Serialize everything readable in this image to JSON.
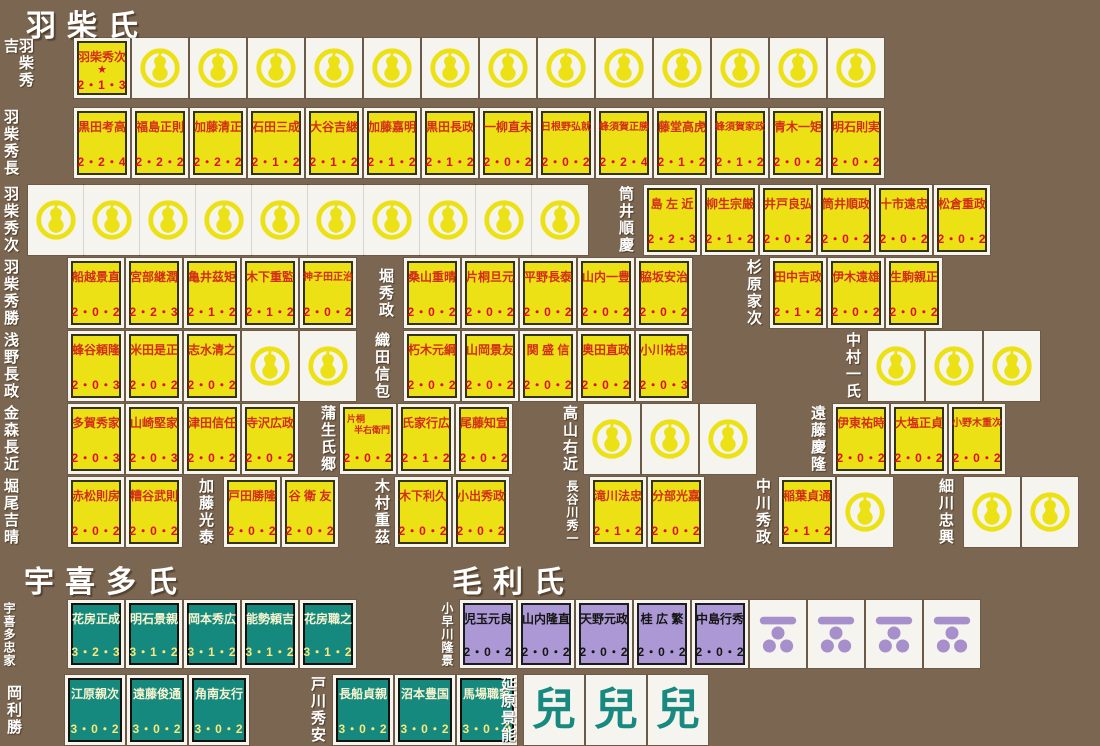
{
  "clans": [
    {
      "title": "羽柴氏"
    },
    {
      "title": "宇喜多氏"
    },
    {
      "title": "毛利氏"
    }
  ],
  "colors": {
    "background": "#7b6751",
    "card_white": "#f6f4ee",
    "unit_yellow": "#ece114",
    "unit_yellow_name": "#d32d18",
    "unit_yellow_stats": "#e20d20",
    "unit_teal": "#15897e",
    "unit_teal_name": "#f8f3cf",
    "unit_teal_stats": "#fbe77d",
    "unit_purple": "#ac98d4",
    "mon_yellow": "#ece114",
    "mon_purple": "#a78fcb",
    "ko_teal": "#17897f",
    "label_white": "#ffffff"
  },
  "glyphs": {
    "ko": "兒",
    "ace_star": "★"
  },
  "groups": [
    {
      "leader": "羽柴秀吉",
      "lx": 3,
      "cx": 74,
      "y": 38,
      "h": 60,
      "cards": [
        {
          "t": "y",
          "n": "羽柴秀次",
          "v": "2・1・3",
          "star": true
        },
        {
          "t": "g",
          "c": 13
        }
      ]
    },
    {
      "leader": "羽柴秀長",
      "lx": 3,
      "cx": 74,
      "y": 108,
      "cards": [
        {
          "t": "y",
          "n": "黒田考高",
          "v": "2・2・4"
        },
        {
          "t": "y",
          "n": "福島正則",
          "v": "2・2・2"
        },
        {
          "t": "y",
          "n": "加藤清正",
          "v": "2・2・2"
        },
        {
          "t": "y",
          "n": "石田三成",
          "v": "2・1・2"
        },
        {
          "t": "y",
          "n": "大谷吉継",
          "v": "2・1・2"
        },
        {
          "t": "y",
          "n": "加藤嘉明",
          "v": "2・1・2"
        },
        {
          "t": "y",
          "n": "黒田長政",
          "v": "2・1・2"
        },
        {
          "t": "y",
          "n": "一柳直未",
          "v": "2・0・2"
        },
        {
          "t": "y",
          "n": "日根野弘就",
          "v": "2・0・2"
        },
        {
          "t": "y",
          "n": "蜂須賀正勝",
          "v": "2・2・4"
        },
        {
          "t": "y",
          "n": "藤堂高虎",
          "v": "2・1・2"
        },
        {
          "t": "y",
          "n": "蜂須賀家政",
          "v": "2・1・2"
        },
        {
          "t": "y",
          "n": "青木一矩",
          "v": "2・0・2"
        },
        {
          "t": "y",
          "n": "明石則実",
          "v": "2・0・2"
        }
      ]
    },
    {
      "leader": "羽柴秀次",
      "lx": 3,
      "cx": 28,
      "y": 185,
      "gap": 0,
      "cards": [
        {
          "t": "g",
          "c": 10
        }
      ]
    },
    {
      "leader": "筒井順慶",
      "lx": 618,
      "cx": 644,
      "y": 185,
      "cards": [
        {
          "t": "y",
          "n": "島 左 近",
          "v": "2・2・3"
        },
        {
          "t": "y",
          "n": "柳生宗厳",
          "v": "2・1・2"
        },
        {
          "t": "y",
          "n": "井戸良弘",
          "v": "2・0・2"
        },
        {
          "t": "y",
          "n": "筒井順政",
          "v": "2・0・2"
        },
        {
          "t": "y",
          "n": "十市遠忠",
          "v": "2・0・2"
        },
        {
          "t": "y",
          "n": "松倉重政",
          "v": "2・0・2"
        }
      ]
    },
    {
      "leader": "羽柴秀勝",
      "lx": 3,
      "cx": 68,
      "y": 258,
      "cards": [
        {
          "t": "y",
          "n": "船越景直",
          "v": "2・0・2"
        },
        {
          "t": "y",
          "n": "宮部継潤",
          "v": "2・2・3"
        },
        {
          "t": "y",
          "n": "亀井茲矩",
          "v": "2・1・2"
        },
        {
          "t": "y",
          "n": "木下重監",
          "v": "2・1・2"
        },
        {
          "t": "y",
          "n": "神子田正治",
          "v": "2・0・2"
        }
      ]
    },
    {
      "leader": "堀秀政",
      "lx": 378,
      "cx": 404,
      "y": 258,
      "cards": [
        {
          "t": "y",
          "n": "桑山重晴",
          "v": "2・0・2"
        },
        {
          "t": "y",
          "n": "片桐旦元",
          "v": "2・0・2"
        },
        {
          "t": "y",
          "n": "平野長泰",
          "v": "2・0・2"
        },
        {
          "t": "y",
          "n": "山内一豊",
          "v": "2・0・2"
        },
        {
          "t": "y",
          "n": "脇坂安治",
          "v": "2・0・2"
        }
      ]
    },
    {
      "leader": "杉原家次",
      "lx": 746,
      "cx": 770,
      "y": 258,
      "cards": [
        {
          "t": "y",
          "n": "田中吉政",
          "v": "2・1・2"
        },
        {
          "t": "y",
          "n": "伊木遠雄",
          "v": "2・0・2"
        },
        {
          "t": "y",
          "n": "生駒親正",
          "v": "2・0・2"
        }
      ]
    },
    {
      "leader": "浅野長政",
      "lx": 3,
      "cx": 68,
      "y": 331,
      "cards": [
        {
          "t": "y",
          "n": "蜂谷頼隆",
          "v": "2・0・3"
        },
        {
          "t": "y",
          "n": "米田是正",
          "v": "2・0・2"
        },
        {
          "t": "y",
          "n": "志水清之",
          "v": "2・0・2"
        },
        {
          "t": "g",
          "c": 2
        }
      ]
    },
    {
      "leader": "織田信包",
      "lx": 374,
      "cx": 404,
      "y": 331,
      "cards": [
        {
          "t": "y",
          "n": "朽木元綱",
          "v": "2・0・2"
        },
        {
          "t": "y",
          "n": "山岡景友",
          "v": "2・0・2"
        },
        {
          "t": "y",
          "n": "関 盛 信",
          "v": "2・0・2"
        },
        {
          "t": "y",
          "n": "奥田直政",
          "v": "2・0・2"
        },
        {
          "t": "y",
          "n": "小川祐忠",
          "v": "2・0・3"
        }
      ]
    },
    {
      "leader": "中村一氏",
      "lx": 845,
      "cx": 868,
      "y": 331,
      "cards": [
        {
          "t": "g",
          "c": 3
        }
      ]
    },
    {
      "leader": "金森長近",
      "lx": 3,
      "cx": 68,
      "y": 404,
      "cards": [
        {
          "t": "y",
          "n": "多賀秀家",
          "v": "2・0・3"
        },
        {
          "t": "y",
          "n": "山崎堅家",
          "v": "2・0・3"
        },
        {
          "t": "y",
          "n": "津田信任",
          "v": "2・0・2"
        },
        {
          "t": "y",
          "n": "寺沢広政",
          "v": "2・0・2"
        }
      ]
    },
    {
      "leader": "蒲生氏郷",
      "lx": 320,
      "cx": 340,
      "y": 404,
      "cards": [
        {
          "t": "y",
          "n": "片桐半右衛門",
          "n2": [
            "片桐",
            "半右衛門"
          ],
          "v": "2・0・2"
        },
        {
          "t": "y",
          "n": "氏家行広",
          "v": "2・1・2"
        },
        {
          "t": "y",
          "n": "尾藤知宣",
          "v": "2・0・2"
        }
      ]
    },
    {
      "leader": "高山右近",
      "lx": 562,
      "cx": 584,
      "y": 404,
      "cards": [
        {
          "t": "g",
          "c": 3
        }
      ]
    },
    {
      "leader": "遠藤慶隆",
      "lx": 810,
      "cx": 833,
      "y": 404,
      "cards": [
        {
          "t": "y",
          "n": "伊東祐時",
          "v": "2・0・2"
        },
        {
          "t": "y",
          "n": "大塩正貞",
          "v": "2・0・2"
        },
        {
          "t": "y",
          "n": "小野木重次",
          "v": "2・0・2"
        }
      ]
    },
    {
      "leader": "堀尾吉晴",
      "lx": 3,
      "cx": 68,
      "y": 477,
      "cards": [
        {
          "t": "y",
          "n": "赤松則房",
          "v": "2・0・2"
        },
        {
          "t": "y",
          "n": "糟谷武則",
          "v": "2・0・2"
        }
      ]
    },
    {
      "leader": "加藤光泰",
      "lx": 198,
      "cx": 224,
      "y": 477,
      "cards": [
        {
          "t": "y",
          "n": "戸田勝隆",
          "v": "2・0・2"
        },
        {
          "t": "y",
          "n": "谷 衛 友",
          "v": "2・0・2"
        }
      ]
    },
    {
      "leader": "木村重茲",
      "lx": 374,
      "cx": 395,
      "y": 477,
      "cards": [
        {
          "t": "y",
          "n": "木下利久",
          "v": "2・0・2"
        },
        {
          "t": "y",
          "n": "小出秀政",
          "v": "2・0・2"
        }
      ]
    },
    {
      "leader": "長谷川秀一",
      "lx": 566,
      "cx": 590,
      "y": 477,
      "cards": [
        {
          "t": "y",
          "n": "滝川法忠",
          "v": "2・1・2"
        },
        {
          "t": "y",
          "n": "分部光嘉",
          "v": "2・0・2"
        }
      ]
    },
    {
      "leader": "中川秀政",
      "lx": 755,
      "cx": 779,
      "y": 477,
      "cards": [
        {
          "t": "y",
          "n": "稲葉貞通",
          "v": "2・1・2"
        },
        {
          "t": "g",
          "c": 1
        }
      ]
    },
    {
      "leader": "細川忠興",
      "lx": 938,
      "cx": 964,
      "y": 477,
      "cards": [
        {
          "t": "g",
          "c": 2
        }
      ]
    },
    {
      "leader": "宇喜多忠家",
      "lx": 3,
      "cx": 68,
      "y": 600,
      "h": 68,
      "cards": [
        {
          "t": "t",
          "n": "花房正成",
          "v": "3・2・3"
        },
        {
          "t": "t",
          "n": "明石景親",
          "v": "3・1・2"
        },
        {
          "t": "t",
          "n": "岡本秀広",
          "v": "3・1・2"
        },
        {
          "t": "t",
          "n": "能勢頼吉",
          "v": "3・1・2"
        },
        {
          "t": "t",
          "n": "花房職之",
          "v": "3・1・2"
        }
      ]
    },
    {
      "leader": "小早川隆景",
      "lx": 441,
      "cx": 460,
      "y": 600,
      "h": 68,
      "cards": [
        {
          "t": "p",
          "n": "児玉元良",
          "v": "2・0・2"
        },
        {
          "t": "p",
          "n": "山内隆直",
          "v": "2・0・2"
        },
        {
          "t": "p",
          "n": "天野元政",
          "v": "2・0・2"
        },
        {
          "t": "p",
          "n": "桂 広 繁",
          "v": "2・0・2"
        },
        {
          "t": "p",
          "n": "中島行秀",
          "v": "2・0・2"
        },
        {
          "t": "m",
          "c": 4
        }
      ]
    },
    {
      "leader": "岡利勝",
      "lx": 6,
      "cx": 65,
      "y": 675,
      "w": 60,
      "cards": [
        {
          "t": "t",
          "n": "江原親次",
          "v": "3・0・2"
        },
        {
          "t": "t",
          "n": "遠藤俊通",
          "v": "3・0・2"
        },
        {
          "t": "t",
          "n": "角南友行",
          "v": "3・0・2"
        }
      ]
    },
    {
      "leader": "戸川秀安",
      "lx": 310,
      "cx": 333,
      "y": 675,
      "w": 60,
      "cards": [
        {
          "t": "t",
          "n": "長船貞親",
          "v": "3・0・2"
        },
        {
          "t": "t",
          "n": "沼本豊国",
          "v": "3・0・2"
        },
        {
          "t": "t",
          "n": "馬場職家",
          "v": "3・0・2"
        }
      ]
    },
    {
      "leader": "延原景能",
      "lx": 500,
      "cx": 524,
      "y": 675,
      "w": 60,
      "cards": [
        {
          "t": "k",
          "c": 3
        }
      ]
    }
  ]
}
